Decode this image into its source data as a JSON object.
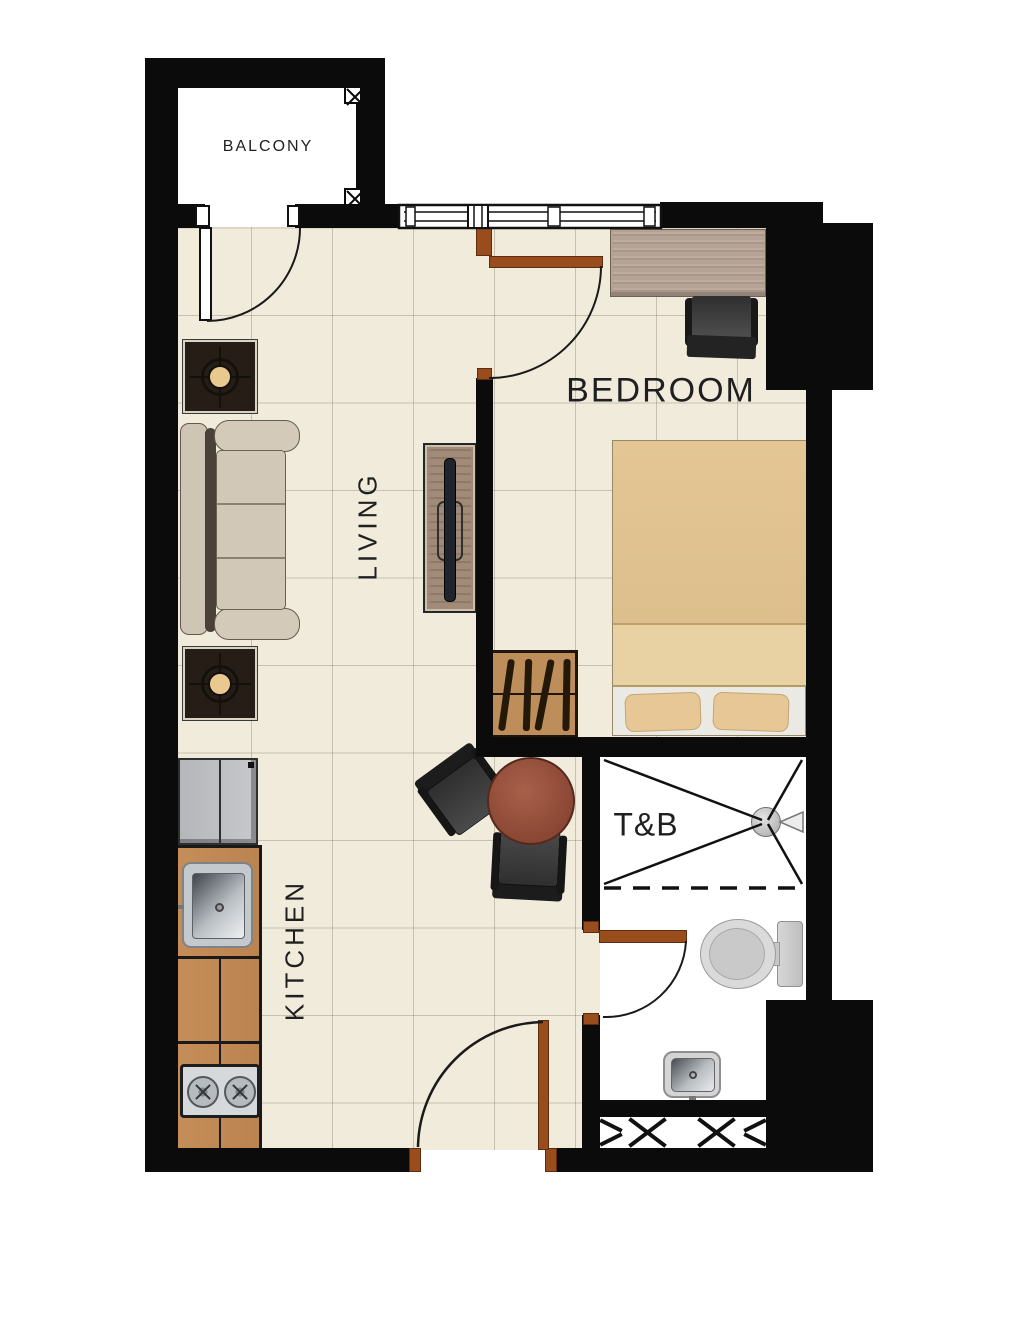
{
  "title": "Studio Condominium Unit Floor Plan",
  "rooms": {
    "balcony": {
      "label": "BALCONY"
    },
    "living": {
      "label": "LIVING"
    },
    "kitchen": {
      "label": "KITCHEN"
    },
    "bedroom": {
      "label": "BEDROOM"
    },
    "toilet_bath": {
      "label": "T&B"
    }
  },
  "colors": {
    "wall": "#0b0b0b",
    "floor_tile": "#f1ebdc",
    "tile_grout": "#c9c3b2",
    "door_wood": "#9a4d1c",
    "cabinet_wood": "#c28a55",
    "dining_table_wood": "#8d4936",
    "bed_linen": "#e0c290",
    "sofa_fabric": "#cfc5b4",
    "desk_wood": "#b4a294",
    "appliance_gray": "#c0c2c6",
    "bath_white": "#ffffff",
    "lamp_shade": "#eac98e",
    "label_text": "#1f1f1f"
  },
  "fixtures": [
    "balcony-door",
    "living-window",
    "entry-door",
    "bedroom-door",
    "bathroom-door",
    "sofa",
    "side-table-lamp-upper",
    "side-table-lamp-lower",
    "tv-console",
    "dining-table",
    "dining-chair-left",
    "dining-chair-bottom",
    "refrigerator",
    "kitchen-counter",
    "kitchen-sink",
    "stove",
    "bed",
    "wardrobe",
    "desk",
    "office-chair",
    "shower-head",
    "shower-screen",
    "toilet",
    "bathroom-sink",
    "louver-vent"
  ]
}
